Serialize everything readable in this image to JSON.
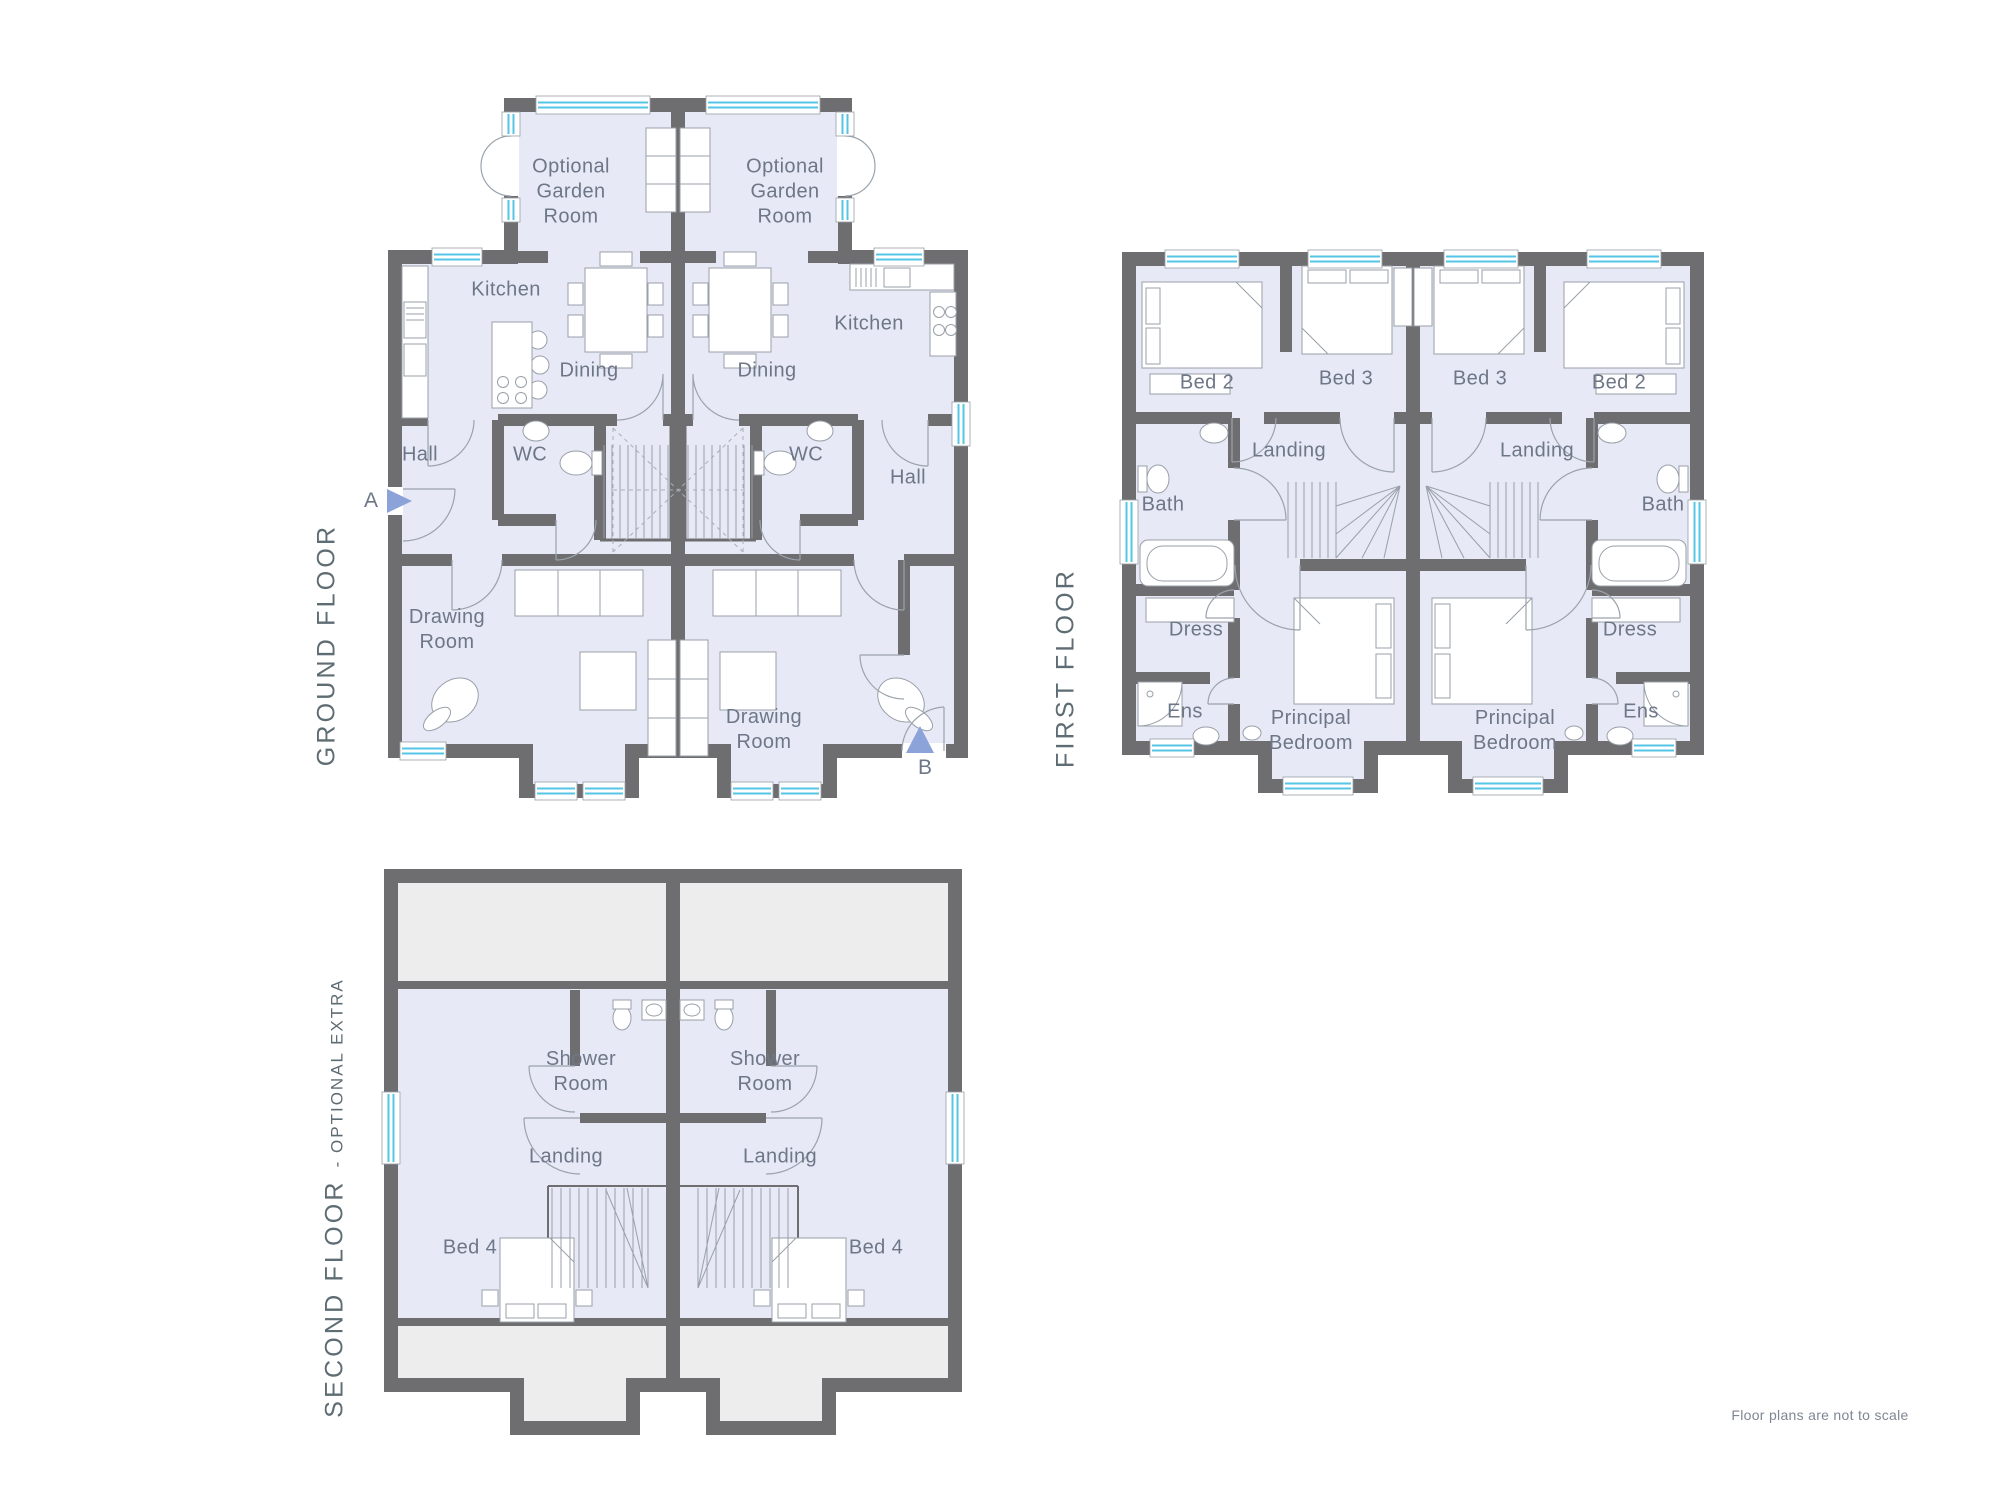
{
  "page": {
    "note": "Floor plans are not to scale"
  },
  "markers": {
    "a": "A",
    "b": "B"
  },
  "colors": {
    "wall": "#6e6e71",
    "room_fill": "#e7e9f6",
    "eaves_fill": "#ededee",
    "window_glass": "#54c5e6",
    "furniture_line": "#98a0a8",
    "door_arc": "#9aa3ac",
    "label_text": "#6e7787",
    "title_text": "#5e6c73",
    "marker_blue": "#8ba3d9"
  },
  "floors": {
    "ground": {
      "title": "GROUND FLOOR",
      "rooms": {
        "garden_left": "Optional\nGarden\nRoom",
        "garden_right": "Optional\nGarden\nRoom",
        "kitchen_left": "Kitchen",
        "kitchen_right": "Kitchen",
        "dining_left": "Dining",
        "dining_right": "Dining",
        "hall_left": "Hall",
        "hall_right": "Hall",
        "wc_left": "WC",
        "wc_right": "WC",
        "drawing_left": "Drawing\nRoom",
        "drawing_right": "Drawing\nRoom"
      }
    },
    "first": {
      "title": "FIRST FLOOR",
      "rooms": {
        "bed2_left": "Bed 2",
        "bed3_left": "Bed 3",
        "bed3_right": "Bed 3",
        "bed2_right": "Bed 2",
        "landing_left": "Landing",
        "landing_right": "Landing",
        "bath_left": "Bath",
        "bath_right": "Bath",
        "dress_left": "Dress",
        "dress_right": "Dress",
        "ens_left": "Ens",
        "ens_right": "Ens",
        "principal_left": "Principal\nBedroom",
        "principal_right": "Principal\nBedroom"
      }
    },
    "second": {
      "title": "SECOND FLOOR",
      "title_suffix": "- OPTIONAL EXTRA",
      "rooms": {
        "shower_left": "Shower\nRoom",
        "shower_right": "Shower\nRoom",
        "landing_left": "Landing",
        "landing_right": "Landing",
        "bed4_left": "Bed 4",
        "bed4_right": "Bed 4"
      }
    }
  }
}
